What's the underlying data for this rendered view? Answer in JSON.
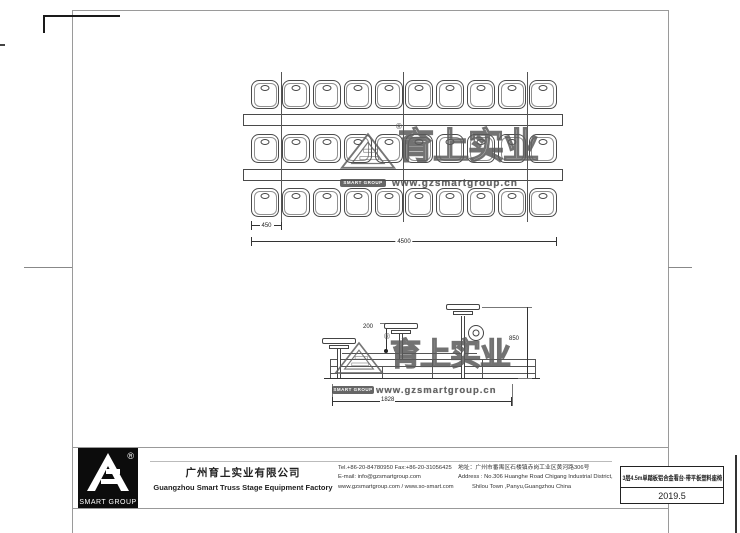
{
  "colors": {
    "paper": "#ffffff",
    "drawing_line": "#444444",
    "frame_line": "#999999",
    "logo_bg": "#0c0c0c",
    "watermark": "#5a5a5a"
  },
  "plan_view": {
    "rows": 3,
    "seats_per_row": 10,
    "dim_seat_pitch": "450",
    "dim_total_width": "4500"
  },
  "side_view": {
    "dim_rise": "200",
    "dim_height": "850",
    "dim_depth": "1828"
  },
  "watermark": {
    "brand_cn": "育上实业",
    "url": "www.gzsmartgroup.cn",
    "logo_caption": "SMART GROUP",
    "registered_mark": "®"
  },
  "title_block": {
    "logo_caption": "SMART GROUP",
    "registered_mark": "®",
    "company_cn": "广州育上实业有限公司",
    "company_en": "Guangzhou Smart Truss Stage Equipment Factory",
    "tel_fax": "Tel.+86-20-84780950  Fax:+86-20-31056425",
    "email": "E-mail: info@gzsmartgroup.com",
    "websites": "www.gzsmartgroup.com / www.so-smart.com",
    "address_cn": "地址：广州市番禺区石楼镇赤岗工业区黄河路306号",
    "address_en1": "Address : No.306 Huanghe Road Chigang Industrial District,",
    "address_en2": "Shilou Town ,Panyu,Guangzhou China",
    "drawing_title": "3层4.5m单踏板铝合金看台-带平板塑料座椅",
    "date": "2019.5"
  }
}
